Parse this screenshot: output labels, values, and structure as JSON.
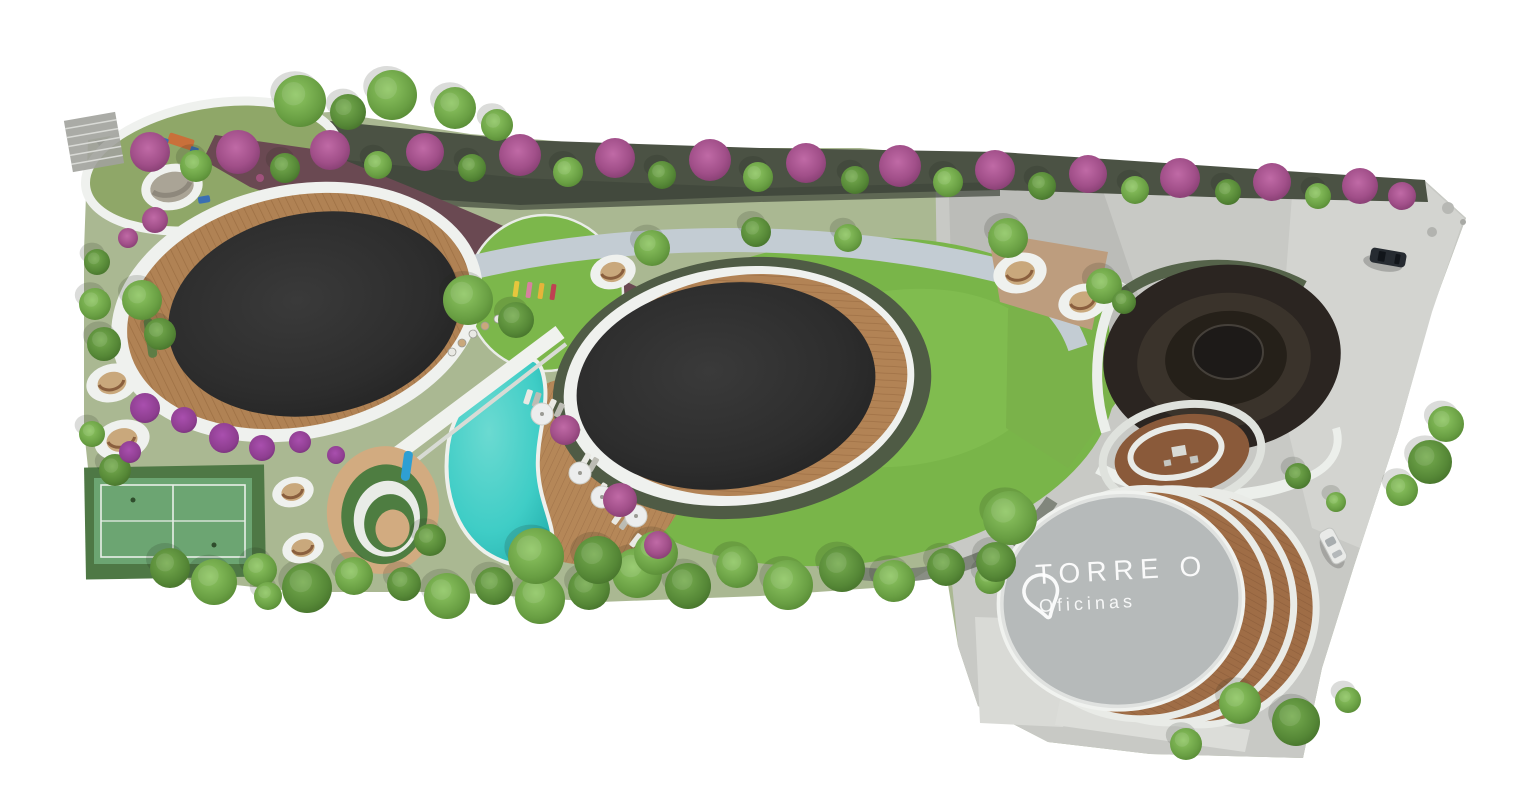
{
  "tower_label": {
    "title": "TORRE O",
    "subtitle": "Oficinas",
    "icon": "location-pin-icon"
  },
  "palette": {
    "background": "#ffffff",
    "lawn_green": "#79b549",
    "olive_ground": "#aab892",
    "playground_green": "#8fa768",
    "perimeter_hedge": "#4b5244",
    "planted_slope_maroon": "#6a4952",
    "flower_purple": "#8e3e90",
    "flower_pink": "#b2539b",
    "pool_turquoise": "#3fcdc6",
    "wood_deck": "#ae7c4f",
    "amenity_roof_black": "#2d2d2d",
    "events_dome_brown": "#2b2521",
    "paving_grey": "#c8c9c5",
    "plaza_light_grey": "#d3d4d0",
    "stone_path_blue_grey": "#c3ccd3",
    "white_path": "#eff1ee",
    "court_green": "#6ca572",
    "court_apron_green": "#4e7845",
    "tower_roof_concrete": "#b9bdbd",
    "label_text": "#f3f5f3"
  }
}
